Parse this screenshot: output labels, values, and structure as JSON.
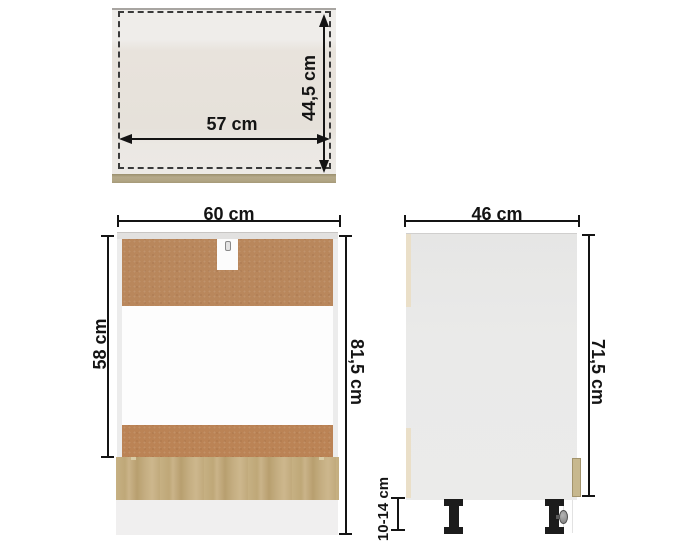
{
  "diagram": {
    "top_view": {
      "width": "57 cm",
      "depth": "44,5 cm"
    },
    "front_view": {
      "width": "60 cm",
      "opening_height": "58 cm",
      "total_height": "81,5 cm"
    },
    "side_view": {
      "depth": "46 cm",
      "body_height": "71,5 cm",
      "leg_height": "10-14 cm"
    },
    "colors": {
      "hardboard_brown": "#b9875c",
      "oak_front": "#c2ab7d",
      "oak_top_edge": "#b1a583",
      "carcass_gray": "#e9e9e9",
      "cream_edge": "#eadfc8",
      "leg_black": "#1c1c1c",
      "dimension_line": "#141414",
      "background": "#ffffff"
    }
  }
}
